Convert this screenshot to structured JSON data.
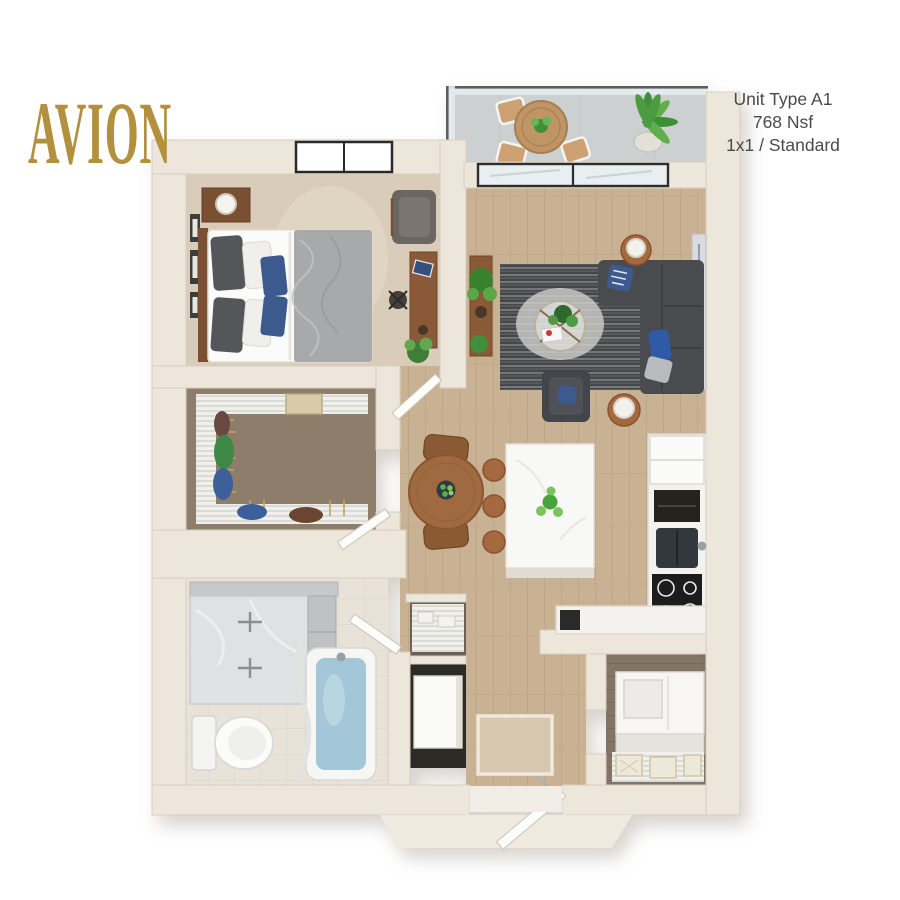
{
  "header": {
    "logo_text": "AVION",
    "unit_lines": [
      "Unit Type A1",
      "768 Nsf",
      "1x1 / Standard"
    ]
  },
  "palette": {
    "brand_gold": "#b2903e",
    "info_text": "#4a4a4a",
    "wall": "#ece6db",
    "wood_floor": "#c9b293",
    "dark_wood_floor": "#837465",
    "bedroom_carpet": "#d9cdba",
    "closet_carpet": "#8d7d6b",
    "bath_tile": "#e8e2d8",
    "balcony_concrete": "#ccd0d1",
    "sofa": "#4a4b4f",
    "accent_blue": "#2f5aa8",
    "tub_water": "#a3c6d8",
    "plant_green": "#4aa33a",
    "furniture_wood": "#a5693f"
  },
  "floorplan": {
    "unit_label": "A1",
    "rooms": [
      {
        "name": "bedroom",
        "features": [
          "bed",
          "nightstand-lamp",
          "wall-art-frames",
          "window",
          "armchair",
          "desk",
          "plant"
        ]
      },
      {
        "name": "walk-in-closet",
        "features": [
          "wire-shelving",
          "hanging-clothes",
          "basket"
        ]
      },
      {
        "name": "living-room",
        "features": [
          "sectional-sofa",
          "accent-chair",
          "area-rug",
          "coffee-table",
          "side-table-lamps",
          "console-plant",
          "wall-art",
          "sliding-glass-door"
        ]
      },
      {
        "name": "kitchen",
        "features": [
          "island-with-stools",
          "refrigerator",
          "oven",
          "sink",
          "cooktop",
          "l-counter"
        ]
      },
      {
        "name": "dining-area",
        "features": [
          "round-table",
          "two-chairs",
          "fruit-bowl"
        ]
      },
      {
        "name": "bathroom",
        "features": [
          "double-vanity",
          "toilet",
          "bathtub",
          "shower-curtain"
        ]
      },
      {
        "name": "utility-closet",
        "features": [
          "wire-shelf",
          "water-heater"
        ]
      },
      {
        "name": "laundry-storage",
        "features": [
          "stacked-washer-dryer",
          "wire-shelf-baskets"
        ]
      },
      {
        "name": "entry",
        "features": [
          "front-door",
          "door-mat"
        ]
      },
      {
        "name": "balcony",
        "features": [
          "glass-railing",
          "bistro-table",
          "two-chairs",
          "potted-plant"
        ]
      }
    ]
  }
}
